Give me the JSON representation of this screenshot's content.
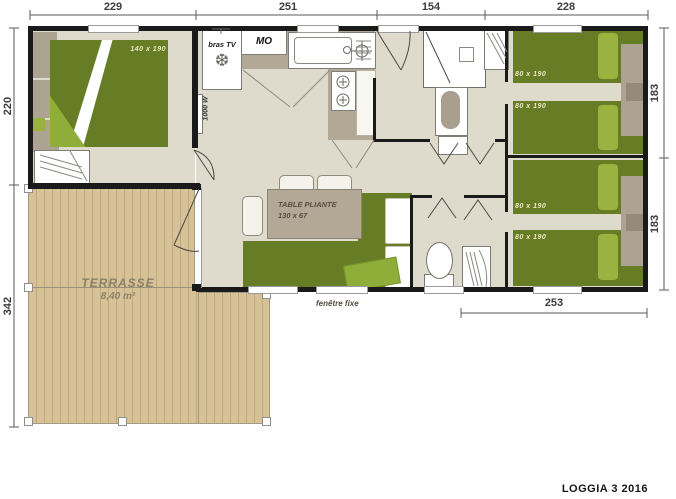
{
  "title": "LOGGIA 3 2016",
  "dimensions": {
    "top": [
      "229",
      "251",
      "154",
      "228"
    ],
    "left": [
      "220",
      "342"
    ],
    "right": [
      "183",
      "183"
    ],
    "bottom_right": "253"
  },
  "rooms": {
    "terrace": {
      "name": "TERRASSE",
      "area": "8,40 m²"
    }
  },
  "furniture": {
    "master_bed": "140 x 190",
    "single_beds": [
      "80 x 190",
      "80 x 190",
      "80 x 190",
      "80 x 190"
    ],
    "table": {
      "line1": "TABLE PLIANTE",
      "line2": "130 x 67"
    }
  },
  "labels": {
    "tv_arm": "bras TV",
    "microwave": "MO",
    "heater": "1000 W",
    "fixed_window": "fenêtre fixe"
  },
  "icons": {
    "freezer_glyph": "❆"
  },
  "colors": {
    "wall": "#1a1a1a",
    "bed_green": "#667d26",
    "pillow_green": "#9ab23f",
    "floor_beige": "#dedacc",
    "deck_wood": "#d7c197",
    "furniture_taupe": "#aca393"
  }
}
